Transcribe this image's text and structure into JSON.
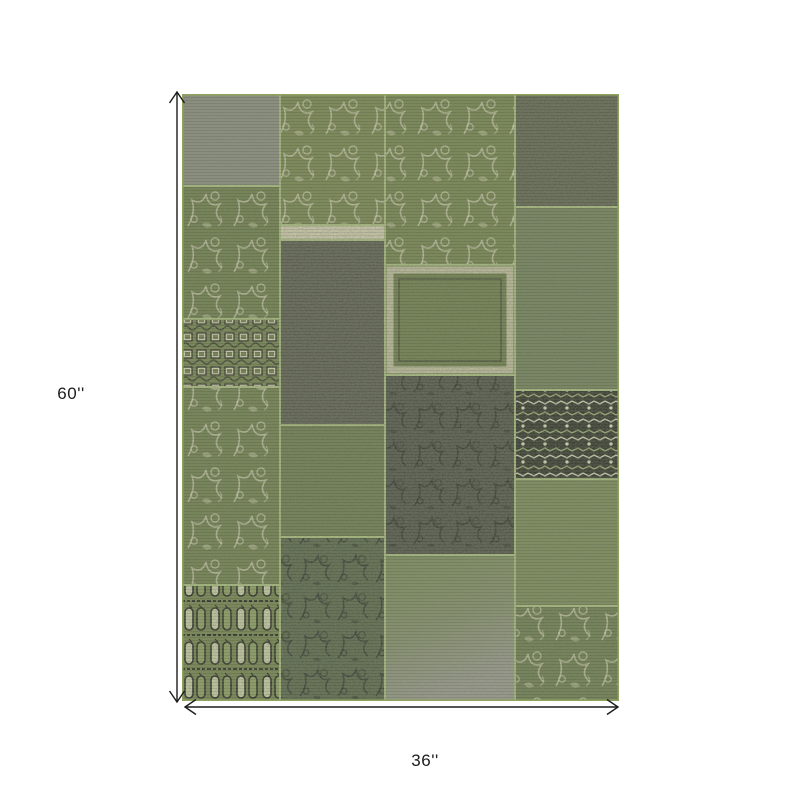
{
  "figure": {
    "description": "Patchwork area rug product dimension diagram",
    "product": "green vintage patchwork rug"
  },
  "colors": {
    "background": "#ffffff",
    "dimension_line": "#1c1c1c",
    "label_text": "#1c1c1c",
    "seam_green": "#a9bd7e",
    "cream": "#d3d0b2",
    "dark_motif": "#32372b",
    "rug_edge": "#8fa25e"
  },
  "dimensions": {
    "height": {
      "label": "60''",
      "x1": 177,
      "y1": 92,
      "x2": 177,
      "y2": 702
    },
    "width": {
      "label": "36''",
      "x1": 185,
      "y1": 707,
      "x2": 618,
      "y2": 707
    }
  },
  "rug": {
    "left": 182,
    "top": 94,
    "width": 437,
    "height": 607,
    "patches": [
      {
        "id": "left-gray-top",
        "x": 0,
        "y": 0,
        "w": 98,
        "h": 92,
        "fill": "#8b8e7e",
        "overlay": null
      },
      {
        "id": "left-floral-upper",
        "x": 0,
        "y": 92,
        "w": 98,
        "h": 133,
        "fill": "#6f7f4c",
        "overlay": "pFloral"
      },
      {
        "id": "left-bead-strip",
        "x": 0,
        "y": 225,
        "w": 98,
        "h": 68,
        "fill": "#76854f",
        "overlay": "pBeads"
      },
      {
        "id": "left-floral-lower",
        "x": 0,
        "y": 293,
        "w": 98,
        "h": 198,
        "fill": "#71814e",
        "overlay": "pFloral"
      },
      {
        "id": "left-ornate-bottom",
        "x": 0,
        "y": 491,
        "w": 98,
        "h": 116,
        "fill": "pOrnate",
        "overlay": null
      },
      {
        "id": "mid1-floral-top",
        "x": 98,
        "y": 0,
        "w": 105,
        "h": 131,
        "fill": "#78874f",
        "overlay": "pFloral"
      },
      {
        "id": "mid1-cream-band",
        "x": 98,
        "y": 131,
        "w": 105,
        "h": 15,
        "fill": "#d0cdae",
        "overlay": null
      },
      {
        "id": "mid1-dark-plain",
        "x": 98,
        "y": 146,
        "w": 105,
        "h": 185,
        "fill": "#5d604f",
        "overlay": null
      },
      {
        "id": "mid1-green-weave",
        "x": 98,
        "y": 331,
        "w": 105,
        "h": 112,
        "fill": "#6d7c4e",
        "overlay": null
      },
      {
        "id": "mid1-dark-floral",
        "x": 98,
        "y": 443,
        "w": 105,
        "h": 164,
        "fill": "#5a684a",
        "overlay": "pFloralDark"
      },
      {
        "id": "mid2-floral-top",
        "x": 203,
        "y": 0,
        "w": 130,
        "h": 171,
        "fill": "#75854e",
        "overlay": "pFloral"
      },
      {
        "id": "mid2-framed-corner",
        "x": 203,
        "y": 171,
        "w": 130,
        "h": 110,
        "fill": "#6f7f4c",
        "overlay": "frame"
      },
      {
        "id": "mid2-dark-speckle",
        "x": 203,
        "y": 281,
        "w": 130,
        "h": 180,
        "fill": "#515648",
        "overlay": "pFloralDark"
      },
      {
        "id": "mid2-gray-fade",
        "x": 203,
        "y": 461,
        "w": 130,
        "h": 146,
        "fill": "gFade",
        "overlay": null
      },
      {
        "id": "right-dark-top",
        "x": 333,
        "y": 0,
        "w": 104,
        "h": 113,
        "fill": "#60664f",
        "overlay": null
      },
      {
        "id": "right-green-mottle",
        "x": 333,
        "y": 113,
        "w": 104,
        "h": 183,
        "fill": "#73825a",
        "overlay": null
      },
      {
        "id": "right-tribal",
        "x": 333,
        "y": 296,
        "w": 104,
        "h": 89,
        "fill": "pTribal",
        "overlay": null
      },
      {
        "id": "right-plain-green",
        "x": 333,
        "y": 385,
        "w": 104,
        "h": 127,
        "fill": "#7b8b58",
        "overlay": null
      },
      {
        "id": "right-floral-bottom",
        "x": 333,
        "y": 512,
        "w": 104,
        "h": 95,
        "fill": "#6e7e50",
        "overlay": "pFloral"
      }
    ]
  }
}
